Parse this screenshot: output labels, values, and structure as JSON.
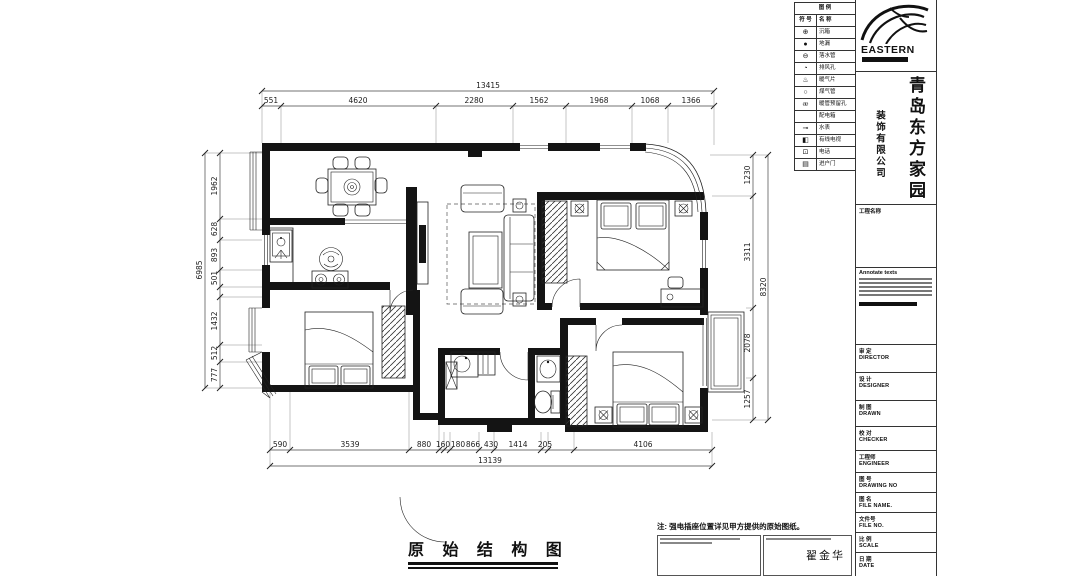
{
  "sheet": {
    "title": "原 始 结 构 图",
    "note": "注: 强电插座位置详见甲方提供的原始图纸。",
    "signature": "翟金华"
  },
  "company": {
    "logo_text": "EASTERN",
    "name_primary": "青岛东方家园",
    "name_secondary": "装饰有限公司",
    "project_label": "工程名称"
  },
  "legend": {
    "header": "图  例",
    "col_symbol": "符 号",
    "col_name": "名 称",
    "rows": [
      {
        "glyph": "⊕",
        "name": "沉箱"
      },
      {
        "glyph": "●",
        "name": "地漏"
      },
      {
        "glyph": "⊖",
        "name": "落水管"
      },
      {
        "glyph": "◔",
        "name": "排风孔"
      },
      {
        "glyph": "♨",
        "name": "暖气片"
      },
      {
        "glyph": "○",
        "name": "煤气管"
      },
      {
        "glyph": "⧞",
        "name": "暖管预留孔"
      },
      {
        "glyph": "",
        "name": "配电箱"
      },
      {
        "glyph": "⊸",
        "name": "水表"
      },
      {
        "glyph": "◧",
        "name": "有线电视"
      },
      {
        "glyph": "⊡",
        "name": "电话"
      },
      {
        "glyph": "▤",
        "name": "进户门"
      }
    ]
  },
  "titleblock": {
    "annotate_label": "Annotate texts",
    "fields": [
      {
        "cn": "审 定",
        "en": "DIRECTOR"
      },
      {
        "cn": "设 计",
        "en": "DESIGNER"
      },
      {
        "cn": "制 图",
        "en": "DRAWN"
      },
      {
        "cn": "校 对",
        "en": "CHECKER"
      },
      {
        "cn": "工程师",
        "en": "ENGINEER"
      },
      {
        "cn": "图 号",
        "en": "DRAWING NO"
      },
      {
        "cn": "图 名",
        "en": "FILE NAME."
      },
      {
        "cn": "文件号",
        "en": "FILE NO."
      },
      {
        "cn": "比 例",
        "en": "SCALE"
      },
      {
        "cn": "日 期",
        "en": "DATE"
      }
    ]
  },
  "dimensions": {
    "top_total": "13415",
    "top": [
      "551",
      "4620",
      "2280",
      "1562",
      "1968",
      "1068",
      "1366"
    ],
    "left_total": "6985",
    "left": [
      "1962",
      "628",
      "893",
      "501",
      "1432",
      "512",
      "777"
    ],
    "right_total": "8320",
    "right": [
      "1230",
      "3311",
      "2078",
      "1257"
    ],
    "bottom_total": "13139",
    "bottom": [
      "590",
      "3539",
      "880",
      "160",
      "180",
      "866",
      "430",
      "1414",
      "205",
      "4106"
    ]
  }
}
